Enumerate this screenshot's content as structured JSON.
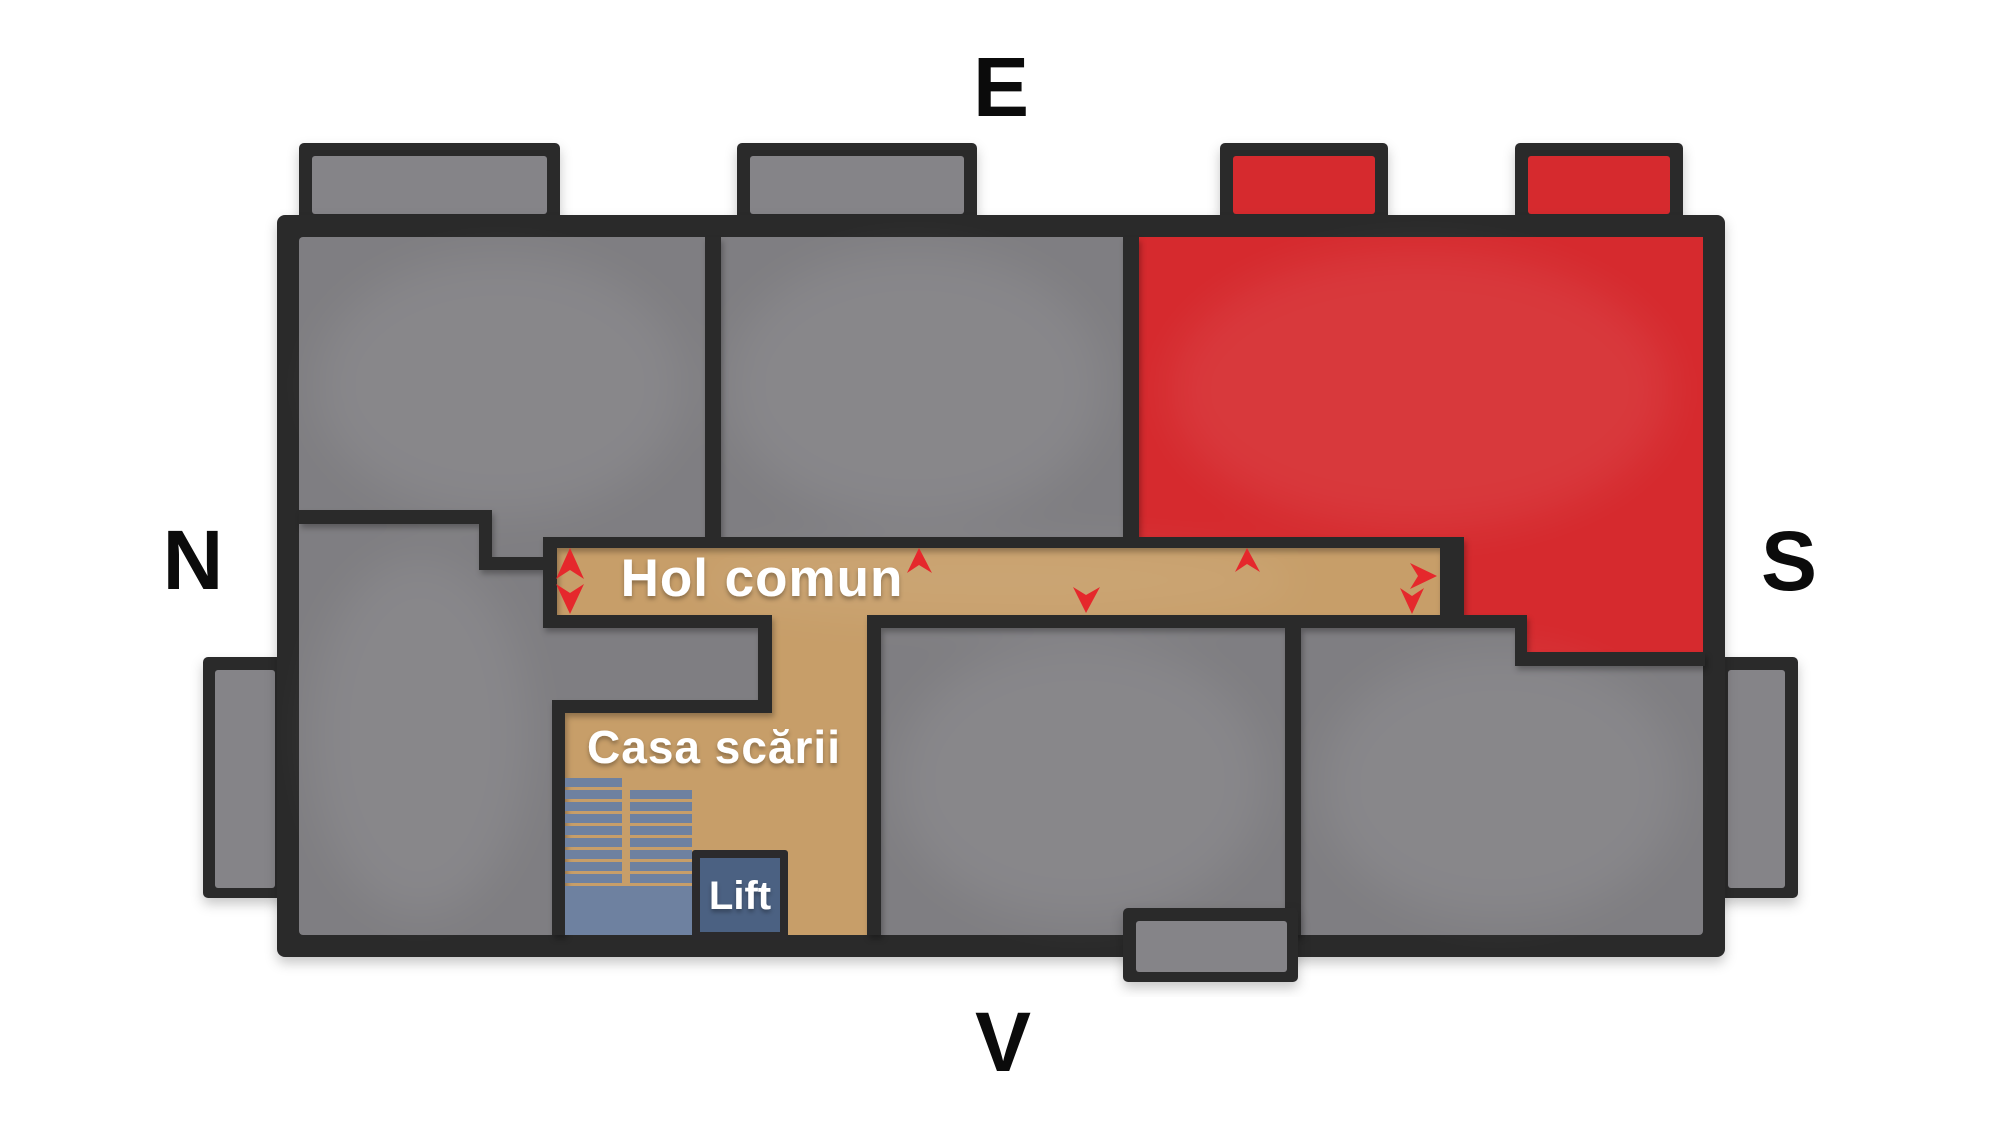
{
  "title": "Etaj - plan apartamente (floor plan)",
  "compass": {
    "east": "E",
    "north": "N",
    "south": "S",
    "west": "V"
  },
  "corridor": {
    "label": "Hol comun",
    "direction_arrows": [
      "up-down-double-arrow",
      "up-arrow",
      "down-arrow",
      "up-arrow",
      "right-arrow",
      "down-arrow"
    ]
  },
  "staircase": {
    "label": "Casa scării"
  },
  "elevator": {
    "label": "Lift"
  },
  "colors": {
    "background": "#ffffff",
    "wall": "#2b2a2c",
    "room_gray": "#7f7e82",
    "balcony_gray": "#858488",
    "apartment_red": "#d62a2e",
    "corridor_tan": "#c79e69",
    "stairs_blue": "#6e81a0",
    "lift_blue": "#4b6182",
    "arrow_red": "#e5282c",
    "label_text": "#ffffff",
    "compass_text": "#0b0b0b"
  }
}
